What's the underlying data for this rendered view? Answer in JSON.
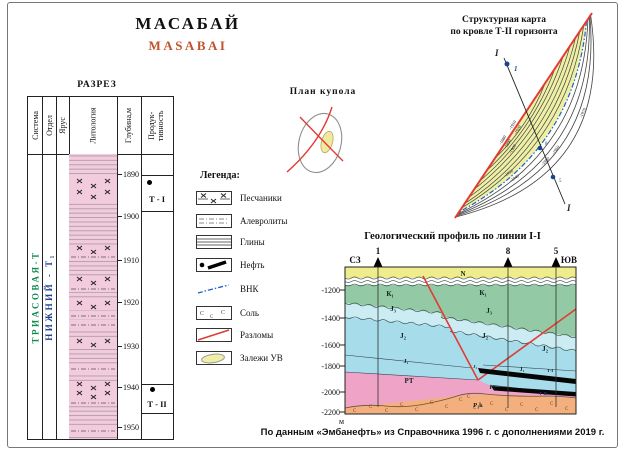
{
  "header": {
    "title_ru": "МАСАБАЙ",
    "title_en": "MASABAI"
  },
  "razrez": {
    "title": "РАЗРЕЗ",
    "headers": [
      "Система",
      "Отдел",
      "Ярус",
      "Литология",
      "Глубина,м",
      "Продук­тивность"
    ],
    "system": "ТРИАСОВАЯ-Т",
    "stage": "НИЖНИЙ - Т₁",
    "depth_ticks": [
      "1890",
      "1900",
      "1910",
      "1920",
      "1930",
      "1940",
      "1950"
    ],
    "horizons": [
      {
        "label": "Т - I"
      },
      {
        "label": "Т - II"
      }
    ]
  },
  "dome_plan": {
    "title": "План купола"
  },
  "legend": {
    "title": "Легенда:",
    "items": [
      "Песчаники",
      "Алевролиты",
      "Глины",
      "Нефть",
      "ВНК",
      "Соль",
      "Разломы",
      "Залежи УВ"
    ]
  },
  "structural_map": {
    "title_line1": "Структурная карта",
    "title_line2": "по кровле Т-II горизонта",
    "section_label_start": "I",
    "section_label_end": "I",
    "well_labels": [
      "1",
      "8",
      "5"
    ],
    "contour_labels": [
      "-1880",
      "-1890",
      "-1900",
      "-1910",
      "-1920",
      "-1930",
      "-1940",
      "-1950",
      "-1960",
      "-1970"
    ]
  },
  "profile": {
    "title": "Геологический профиль по линии I-I",
    "direction_left": "СЗ",
    "direction_right": "ЮВ",
    "wells": [
      "1",
      "8",
      "5"
    ],
    "depth_ticks": [
      "-1200",
      "-1400",
      "-1600",
      "-1800",
      "-2000",
      "-2200"
    ],
    "depth_unit": "м",
    "layer_labels": {
      "n": "N",
      "k1": "К₁",
      "j3": "J₃",
      "j2": "J₂",
      "j1": "J₁",
      "pt": "РТ",
      "p1k": "P₁k"
    },
    "horizon_labels": {
      "t1": "Т-I",
      "t2": "Т-II"
    }
  },
  "symbols": {
    "salt_c": "С"
  },
  "caption": "По данным «Эмбанефть» из Справочника 1996 г. с дополнениями 2019 г.",
  "colors": {
    "accent_orange": "#c0532b",
    "fault_red": "#e23b33",
    "vnk_blue": "#2060c8",
    "system_green": "#118a4c",
    "stage_blue": "#223f8f",
    "deposit_yellow": "#eff0a6"
  }
}
